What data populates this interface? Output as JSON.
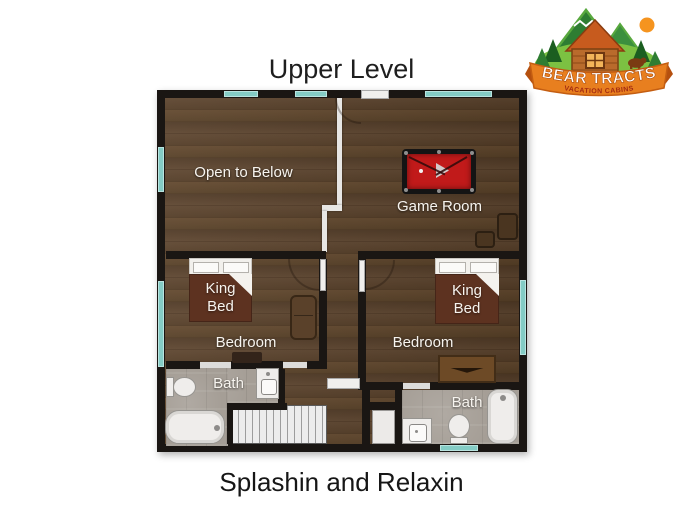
{
  "title": "Upper Level",
  "caption": "Splashin and Relaxin",
  "logo": {
    "brand": "BEAR TRACTS",
    "tagline": "VACATION CABINS"
  },
  "rooms": {
    "open_to_below": "Open to Below",
    "game_room": "Game Room",
    "bedroom_left": "Bedroom",
    "bedroom_right": "Bedroom",
    "bath_left": "Bath",
    "bath_right": "Bath"
  },
  "furniture": {
    "king_bed_left": "King Bed",
    "king_bed_right": "King Bed"
  },
  "colors": {
    "wall": "#1a1613",
    "wood_floor": "#573f29",
    "tile_floor": "#a59e96",
    "window_teal": "#84ccc5",
    "railing_white": "#e7e6e4",
    "pool_table_felt": "#c11a1a",
    "bed_blanket": "#5d3220",
    "logo_banner_orange": "#e87f1f",
    "logo_green": "#2e7d32",
    "logo_sub_text_red": "#a32b12"
  }
}
